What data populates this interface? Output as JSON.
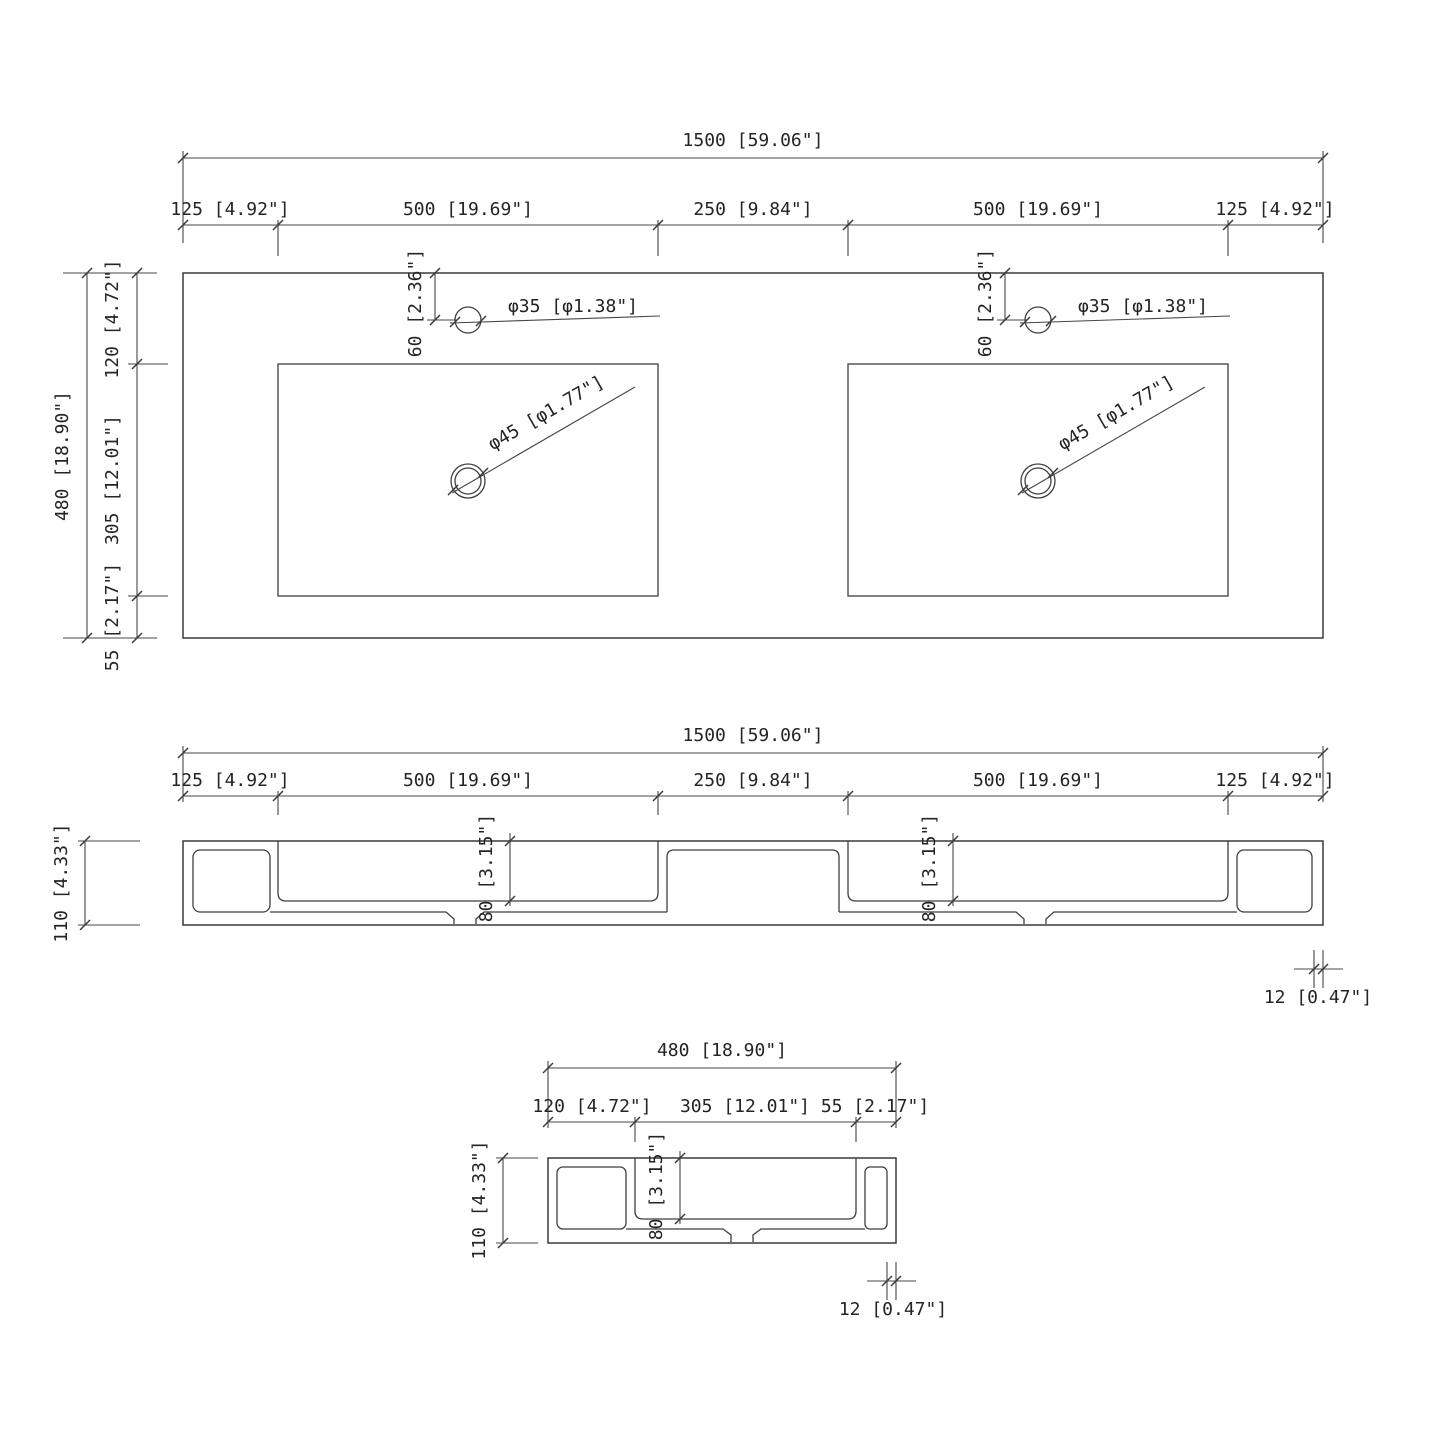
{
  "drawing_type": "technical-dimension-drawing",
  "views": {
    "top": {
      "width_total": "1500 [59.06\"]",
      "width_segments": [
        "125 [4.92\"]",
        "500 [19.69\"]",
        "250 [9.84\"]",
        "500 [19.69\"]",
        "125 [4.92\"]"
      ],
      "depth_total": "480 [18.90\"]",
      "depth_segments": [
        "120 [4.72\"]",
        "305 [12.01\"]",
        "55 [2.17\"]"
      ],
      "faucet_offset": "60 [2.36\"]",
      "faucet_hole_dia": "φ35 [φ1.38\"]",
      "drain_dia": "φ45 [φ1.77\"]"
    },
    "front": {
      "width_total": "1500 [59.06\"]",
      "width_segments": [
        "125 [4.92\"]",
        "500 [19.69\"]",
        "250 [9.84\"]",
        "500 [19.69\"]",
        "125 [4.92\"]"
      ],
      "height": "110 [4.33\"]",
      "basin_depth": "80 [3.15\"]",
      "wall_thickness": "12 [0.47\"]"
    },
    "side": {
      "depth_total": "480 [18.90\"]",
      "depth_segments": [
        "120 [4.72\"]",
        "305 [12.01\"]",
        "55 [2.17\"]"
      ],
      "height": "110 [4.33\"]",
      "basin_depth": "80 [3.15\"]",
      "wall_thickness": "12 [0.47\"]"
    }
  },
  "colors": {
    "background": "#ffffff",
    "object_line": "#3a3a3a",
    "dimension_line": "#474747",
    "text": "#242424"
  }
}
